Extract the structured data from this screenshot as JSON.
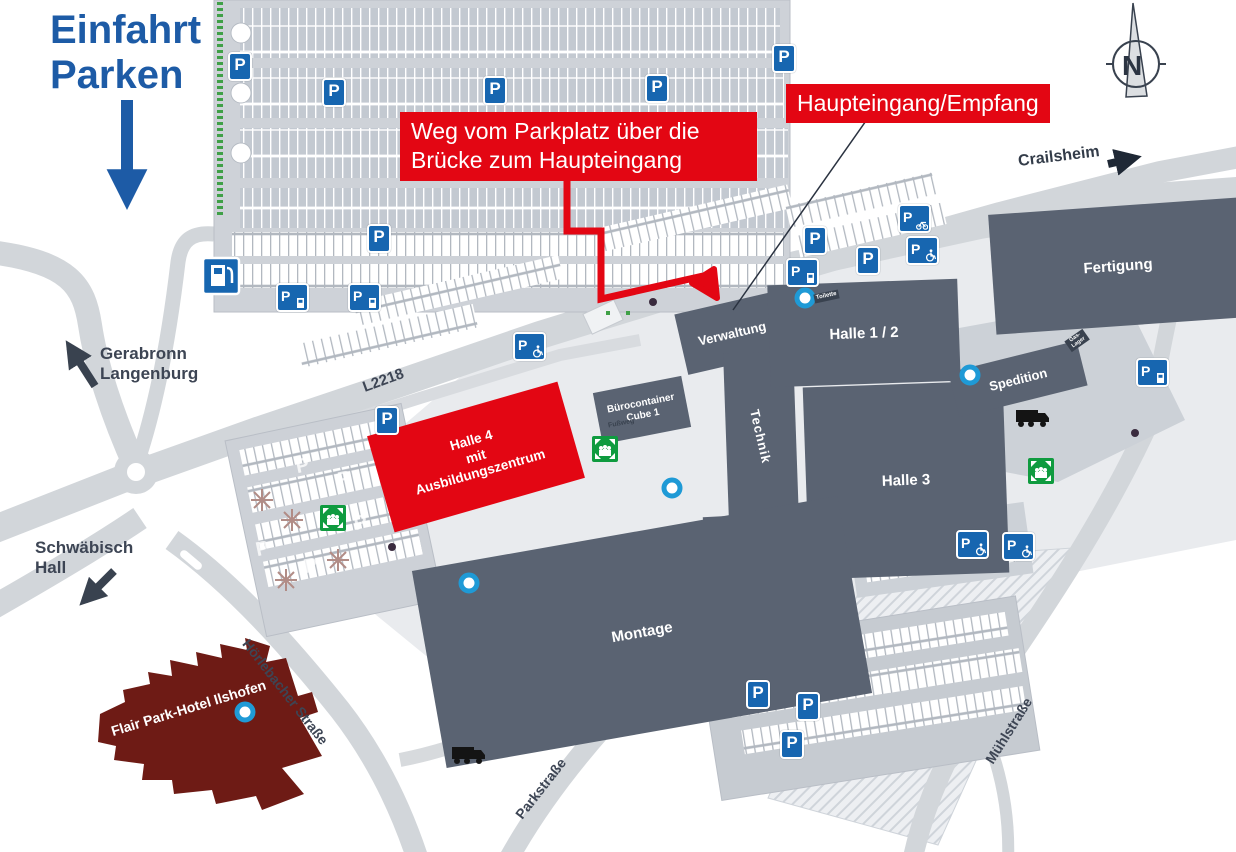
{
  "header": {
    "entry_title": "Einfahrt\nParken"
  },
  "callouts": {
    "route": "Weg vom Parkplatz über die Brücke zum Haupteingang",
    "entrance": "Haupteingang/Empfang"
  },
  "directions": {
    "crailsheim": "Crailsheim",
    "gerabronn_langenburg": "Gerabronn\nLangenburg",
    "schwaebisch_hall": "Schwäbisch\nHall"
  },
  "streets": {
    "l2218": "L2218",
    "hoerlebacher": "Hörlebacher Straße",
    "parkstrasse": "Parkstraße",
    "muehlstrasse": "Mühlstraße",
    "fussweg": "Fußweg"
  },
  "buildings": {
    "verwaltung": "Verwaltung",
    "technik": "Technik",
    "halle_1_2": "Halle 1 / 2",
    "halle_3": "Halle 3",
    "fertigung": "Fertigung",
    "spedition": "Spedition",
    "logistik": "Logistik",
    "montage": "Montage",
    "halle_4": "Halle 4\nmit\nAusbildungszentrum",
    "buerocontainer": "Bürocontainer\nCube 1",
    "hotel": "Flair Park-Hotel\nIlshofen"
  },
  "labels": {
    "toilette": "Toilette",
    "gas_lager": "Gas-Lager"
  },
  "icons": {
    "parking": "P",
    "compass_north": "N"
  },
  "colors": {
    "accent_blue": "#1d5ba6",
    "signal_red": "#e30613",
    "building_gray": "#5a6372",
    "hotel_maroon": "#6e1b15",
    "assembly_green": "#0f9b3f",
    "marker_blue": "#1f9ad6",
    "parking_blue": "#1766b0",
    "road_gray": "#d2d6da"
  }
}
